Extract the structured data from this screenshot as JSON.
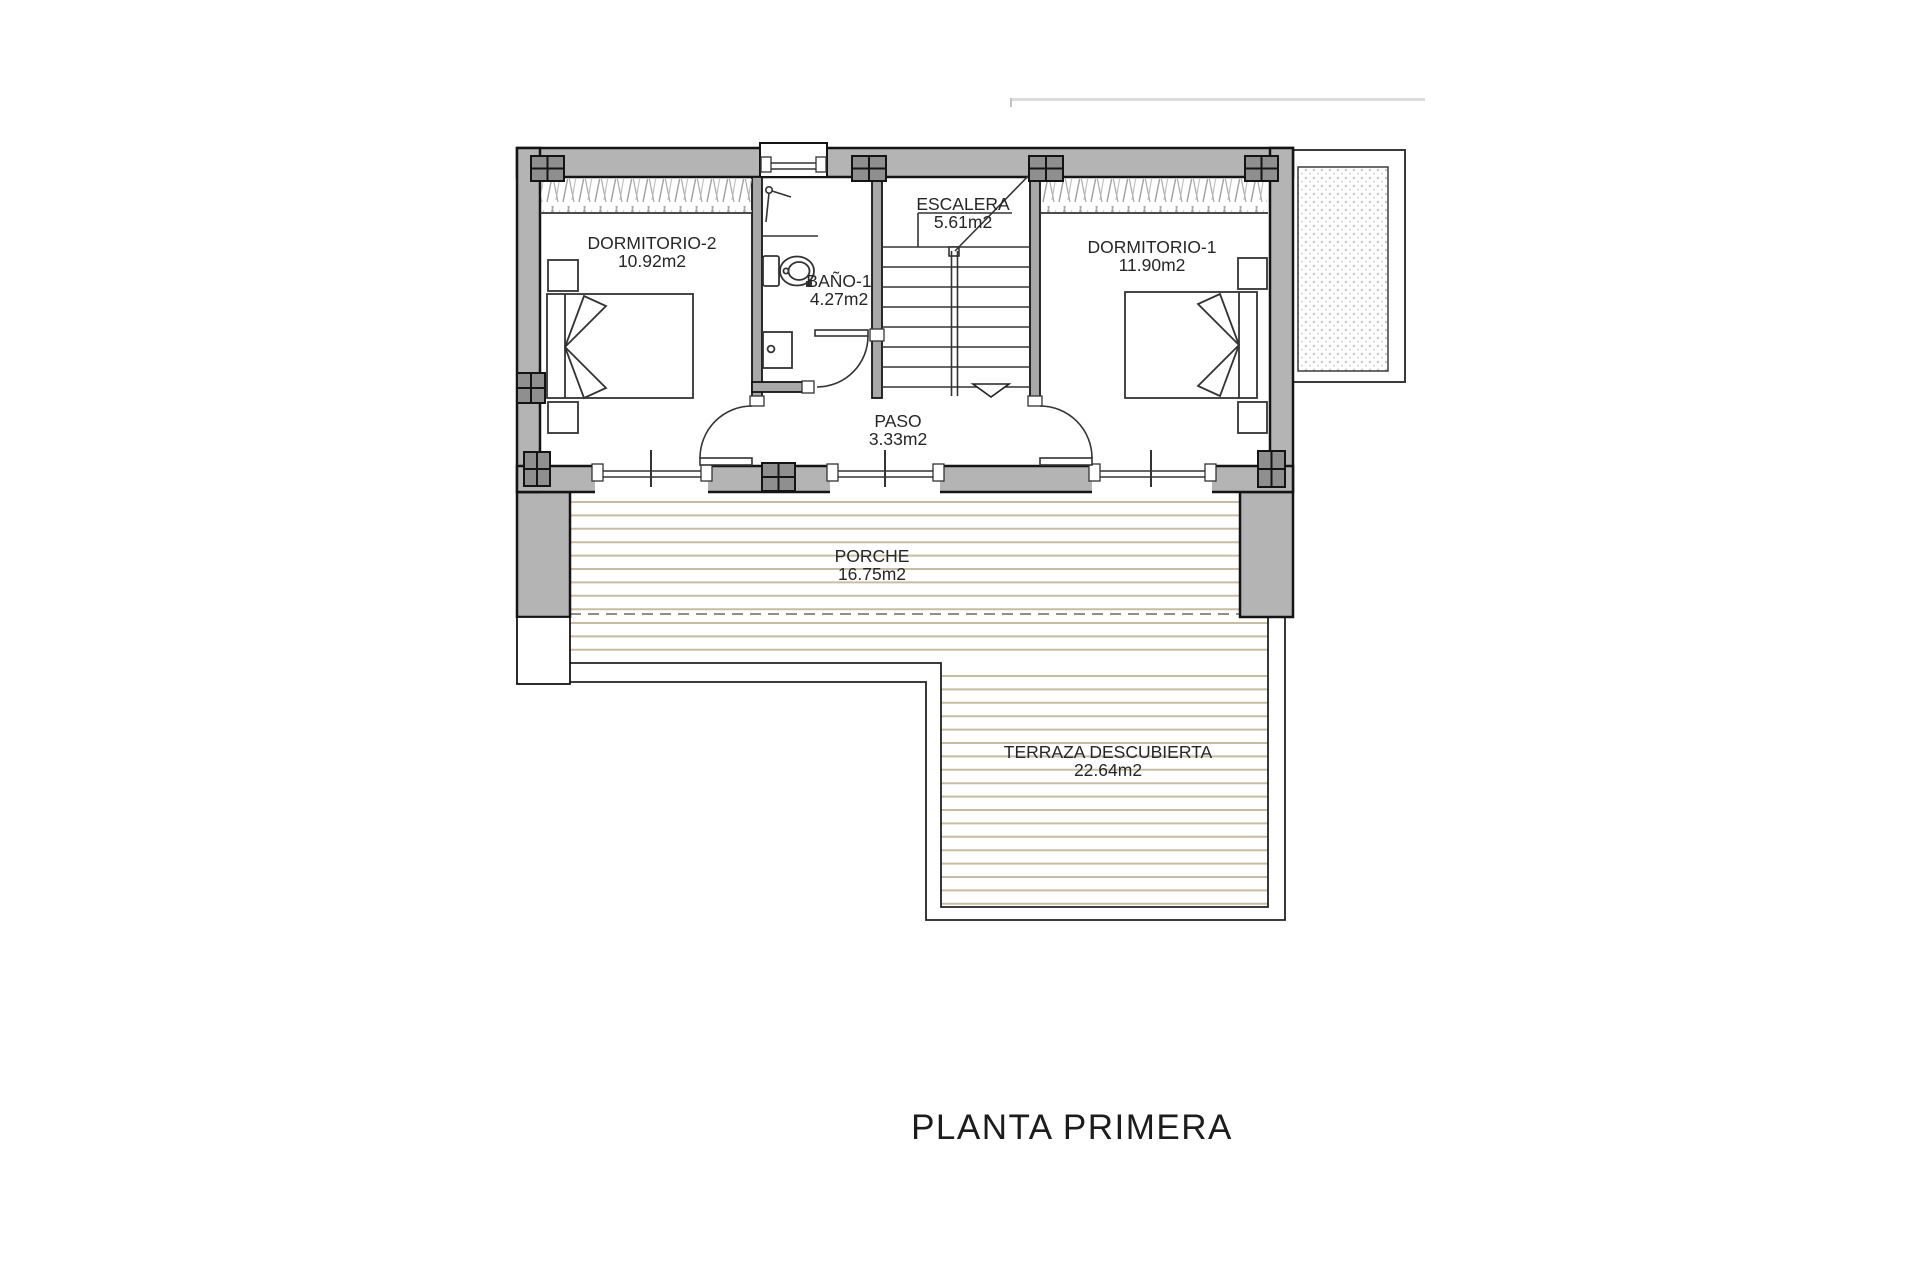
{
  "title": {
    "label": "PLANTA PRIMERA",
    "cx": 1072,
    "cy": 1128
  },
  "rooms": [
    {
      "id": "dormitorio-2",
      "name": "DORMITORIO-2",
      "area": "10.92m2",
      "cx": 652,
      "cy": 243
    },
    {
      "id": "bano-1",
      "name": "BAÑO-1",
      "area": "4.27m2",
      "cx": 839,
      "cy": 281
    },
    {
      "id": "escalera",
      "name": "ESCALERA",
      "area": "5.61m2",
      "cx": 963,
      "cy": 204
    },
    {
      "id": "dormitorio-1",
      "name": "DORMITORIO-1",
      "area": "11.90m2",
      "cx": 1152,
      "cy": 247
    },
    {
      "id": "paso",
      "name": "PASO",
      "area": "3.33m2",
      "cx": 898,
      "cy": 421
    },
    {
      "id": "porche",
      "name": "PORCHE",
      "area": "16.75m2",
      "cx": 872,
      "cy": 556
    },
    {
      "id": "terraza",
      "name": "TERRAZA DESCUBIERTA",
      "area": "22.64m2",
      "cx": 1108,
      "cy": 752
    }
  ],
  "colors": {
    "wall_fill": "#b4b4b4",
    "interior_wall_fill": "#a8a8a8",
    "column_fill": "#8f8f8f",
    "outline": "#141414",
    "thin_line": "#333333",
    "deck_line": "#c6bda4",
    "dashed_line": "#8f8f8f",
    "hatch_line": "#9f9f9f",
    "stipple_dot": "#c8c8c8",
    "text": "#262626",
    "faint_line": "#dcdcdc"
  },
  "deck_line_regions": [
    {
      "x1": 570,
      "x2": 1240,
      "y1": 502,
      "y2": 613
    },
    {
      "x1": 570,
      "x2": 1268,
      "y1": 623,
      "y2": 662
    },
    {
      "x1": 941,
      "x2": 1268,
      "y1": 676,
      "y2": 906
    }
  ],
  "deck_line_spacing": 13.4
}
